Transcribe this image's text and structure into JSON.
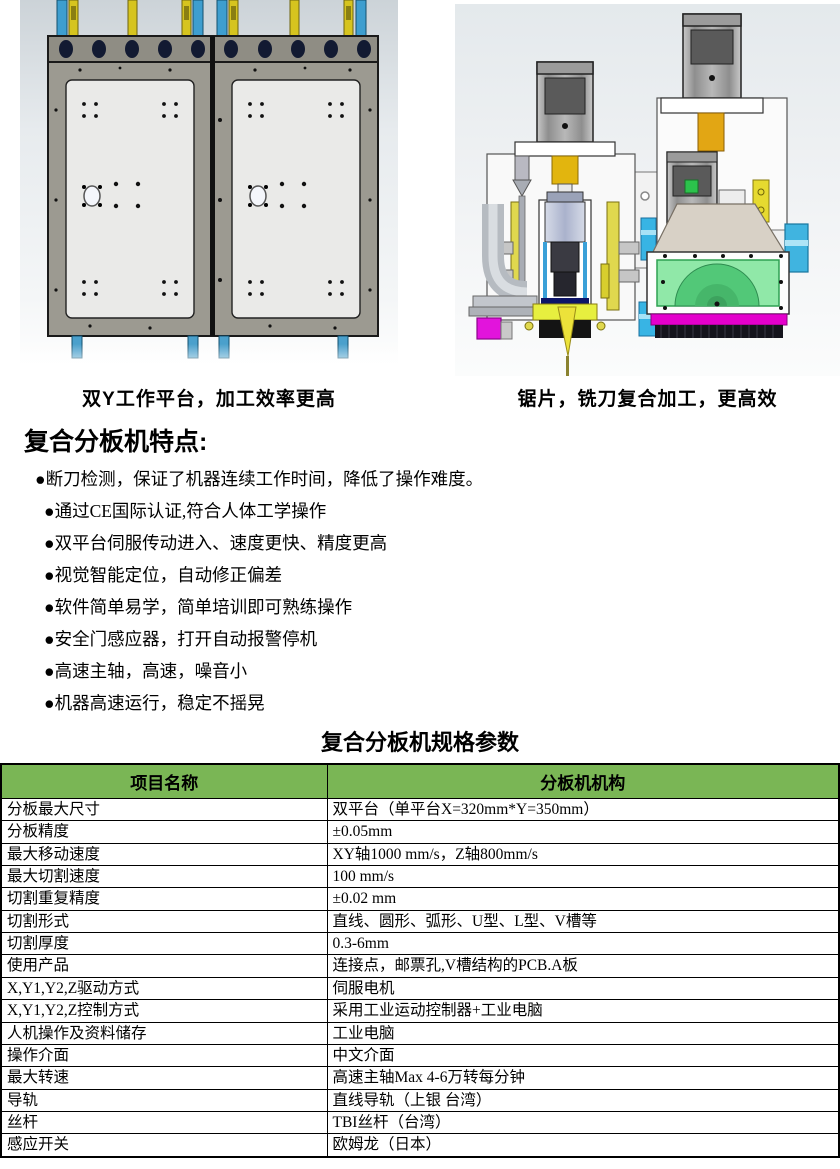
{
  "figures": {
    "left_caption": "双Y工作平台，加工效率更高",
    "right_caption": "锯片，铣刀复合加工，更高效",
    "left_alt": "dual-y-platform-render",
    "right_alt": "saw-and-mill-spindle-render"
  },
  "features": {
    "title": "复合分板机特点:",
    "items": [
      "●断刀检测，保证了机器连续工作时间，降低了操作难度。",
      "●通过CE国际认证,符合人体工学操作",
      "●双平台伺服传动进入、速度更快、精度更高",
      "●视觉智能定位，自动修正偏差",
      "●软件简单易学，简单培训即可熟练操作",
      "●安全门感应器，打开自动报警停机",
      "●高速主轴，高速，噪音小",
      "●机器高速运行，稳定不摇晃"
    ]
  },
  "spec_table": {
    "title": "复合分板机规格参数",
    "header": {
      "name": "项目名称",
      "structure": "分板机机构"
    },
    "header_bg": "#7ab655",
    "rows": [
      {
        "name": "分板最大尺寸",
        "value": "双平台（单平台X=320mm*Y=350mm）"
      },
      {
        "name": "分板精度",
        "value": "±0.05mm"
      },
      {
        "name": "最大移动速度",
        "value": "XY轴1000 mm/s，Z轴800mm/s"
      },
      {
        "name": "最大切割速度",
        "value": "100 mm/s"
      },
      {
        "name": "切割重复精度",
        "value": "±0.02 mm"
      },
      {
        "name": "切割形式",
        "value": "直线、圆形、弧形、U型、L型、V槽等"
      },
      {
        "name": "切割厚度",
        "value": "0.3-6mm"
      },
      {
        "name": "使用产品",
        "value": "连接点，邮票孔,V槽结构的PCB.A板"
      },
      {
        "name": "X,Y1,Y2,Z驱动方式",
        "value": "伺服电机"
      },
      {
        "name": "X,Y1,Y2,Z控制方式",
        "value": "采用工业运动控制器+工业电脑"
      },
      {
        "name": "人机操作及资料储存",
        "value": "工业电脑"
      },
      {
        "name": "操作介面",
        "value": "中文介面"
      },
      {
        "name": "最大转速",
        "value": "高速主轴Max 4-6万转每分钟"
      },
      {
        "name": "导轨",
        "value": "直线导轨（上银 台湾）"
      },
      {
        "name": "丝杆",
        "value": "TBI丝杆（台湾）"
      },
      {
        "name": "感应开关",
        "value": "欧姆龙（日本）"
      }
    ]
  }
}
